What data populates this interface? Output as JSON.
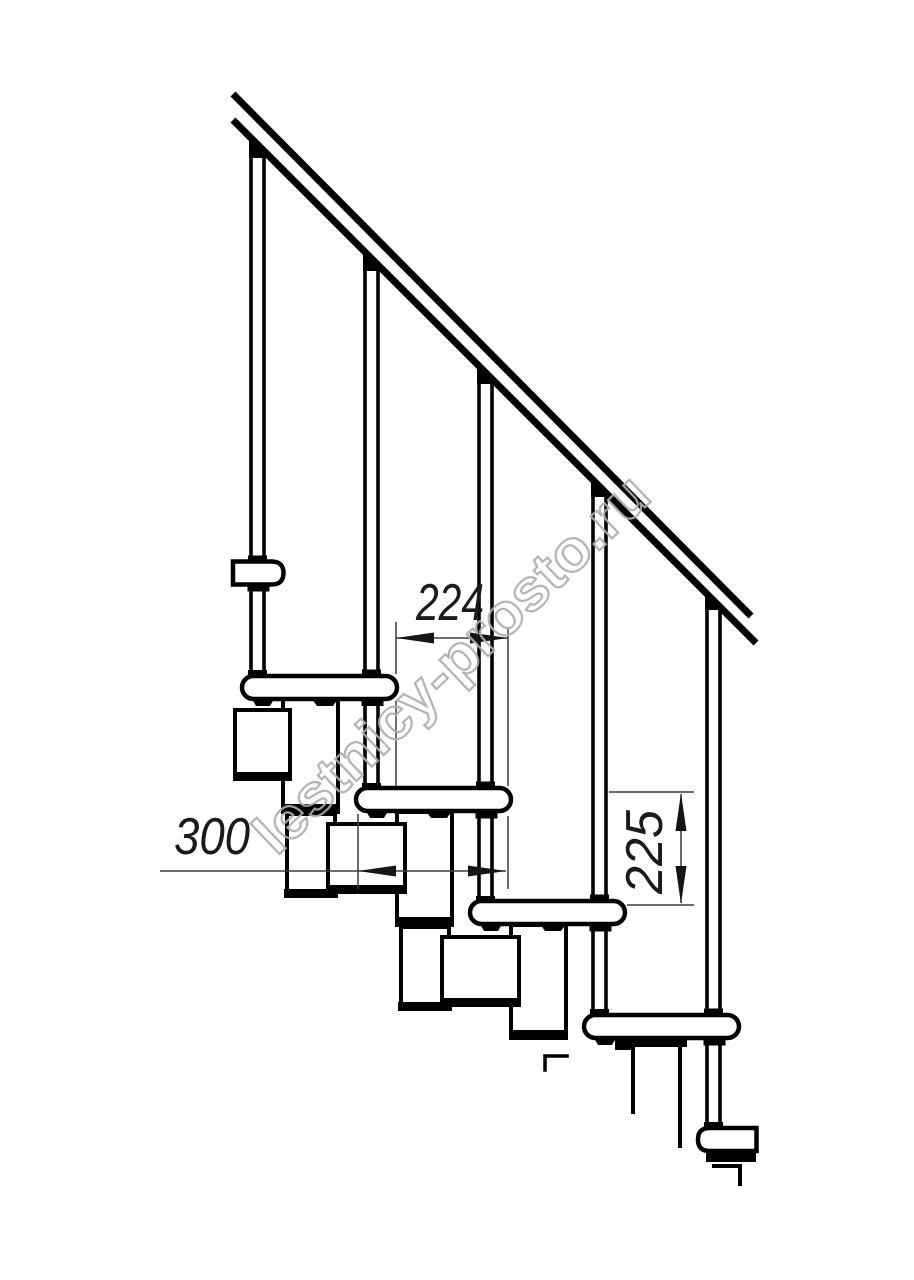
{
  "page": {
    "background": "#ffffff"
  },
  "drawing": {
    "subject": "modular-staircase-side-view",
    "line_color": "#000000",
    "dimension_color": "#3d3d3d",
    "balusters_count": 5,
    "treads_visible": 6,
    "dimensions": {
      "step_run": "224",
      "tread_depth": "300",
      "step_rise": "225"
    }
  },
  "watermark": {
    "text": "lestnicy-prosto.ru",
    "color": "#aeaeae"
  }
}
